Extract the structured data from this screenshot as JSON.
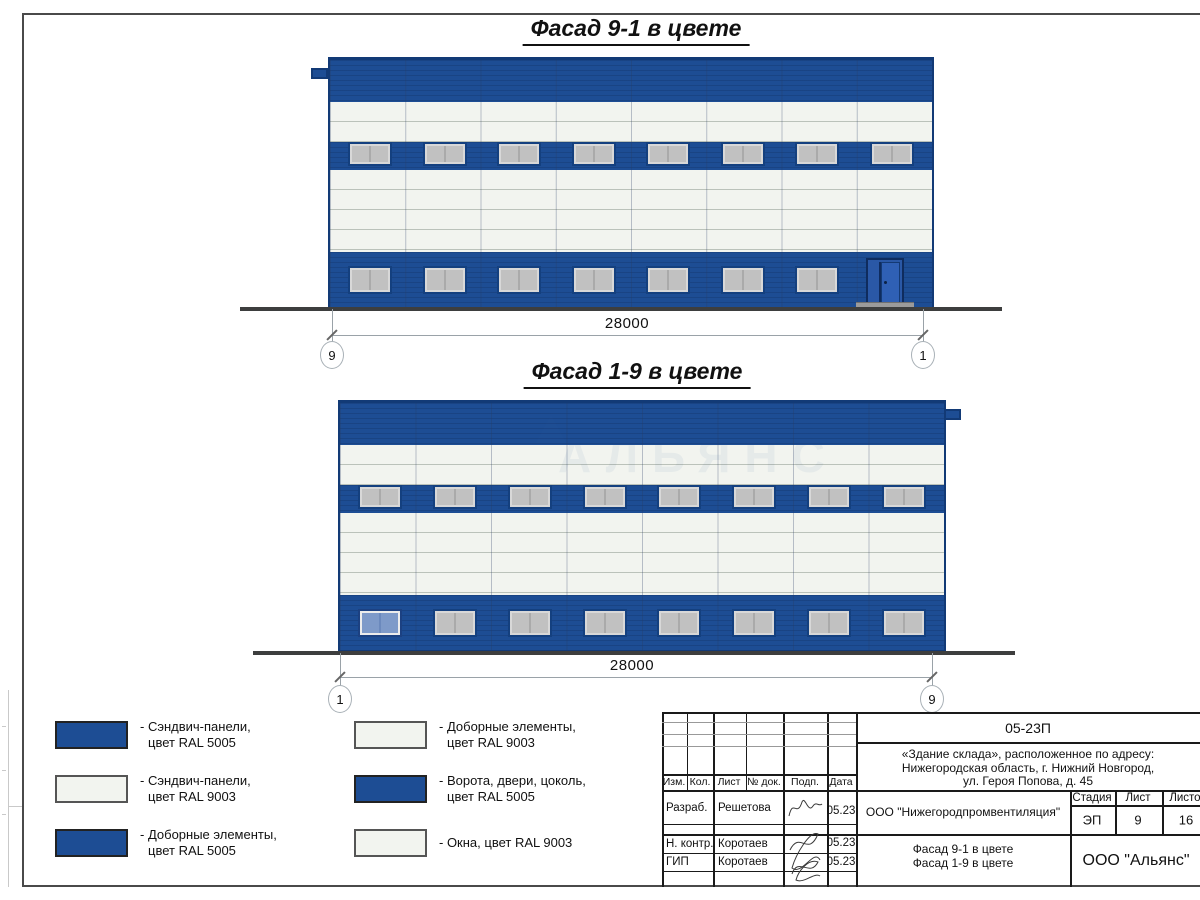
{
  "facade1": {
    "title": "Фасад 9-1 в цвете",
    "dimension": "28000",
    "axis_left": "9",
    "axis_right": "1",
    "upper_window_count": 8,
    "lower_window_count": 7,
    "has_door": true
  },
  "facade2": {
    "title": "Фасад 1-9 в цвете",
    "dimension": "28000",
    "axis_left": "1",
    "axis_right": "9",
    "upper_window_count": 8,
    "lower_window_count": 8,
    "first_lower_window_blue": true
  },
  "watermark": "АЛЬЯНС",
  "colors": {
    "panel_blue_ral5005": "#1d4d94",
    "panel_white_ral9003": "#f2f4ef",
    "window_gray": "#c1c1c1",
    "ground": "#3d3e3e"
  },
  "legend": {
    "items": [
      {
        "swatch": "blue",
        "line1": "- Сэндвич-панели,",
        "line2": "цвет RAL 5005"
      },
      {
        "swatch": "white",
        "line1": "- Сэндвич-панели,",
        "line2": "цвет RAL 9003"
      },
      {
        "swatch": "blue",
        "line1": "- Доборные элементы,",
        "line2": "цвет RAL 5005"
      },
      {
        "swatch": "white",
        "line1": "- Доборные элементы,",
        "line2": "цвет RAL 9003"
      },
      {
        "swatch": "blue",
        "line1": "- Ворота, двери, цоколь,",
        "line2": "цвет RAL 5005"
      },
      {
        "swatch": "white",
        "line1": "- Окна, цвет RAL 9003",
        "line2": ""
      }
    ]
  },
  "title_block": {
    "code": "05-23П",
    "address_line1": "«Здание склада», расположенное по адресу:",
    "address_line2": "Нижегородская область, г. Нижний Новгород,",
    "address_line3": "ул. Героя Попова, д. 45",
    "columns": {
      "izm": "Изм.",
      "kol": "Кол.",
      "list": "Лист",
      "doc": "№ док.",
      "podp": "Подп.",
      "data": "Дата"
    },
    "rows": [
      {
        "role": "Разраб.",
        "name": "Решетова",
        "date": "05.23"
      },
      {
        "role": "Н. контр.",
        "name": "Коротаев",
        "date": "05.23"
      },
      {
        "role": "ГИП",
        "name": "Коротаев",
        "date": "05.23"
      }
    ],
    "organization": "ООО \"Нижегородпромвентиляция\"",
    "sheet_title_line1": "Фасад 9-1 в цвете",
    "sheet_title_line2": "Фасад 1-9 в цвете",
    "stage_label": "Стадия",
    "sheet_label": "Лист",
    "sheets_label": "Листов",
    "stage_value": "ЭП",
    "sheet_value": "9",
    "sheets_value": "16",
    "company": "ООО \"Альянс\""
  }
}
